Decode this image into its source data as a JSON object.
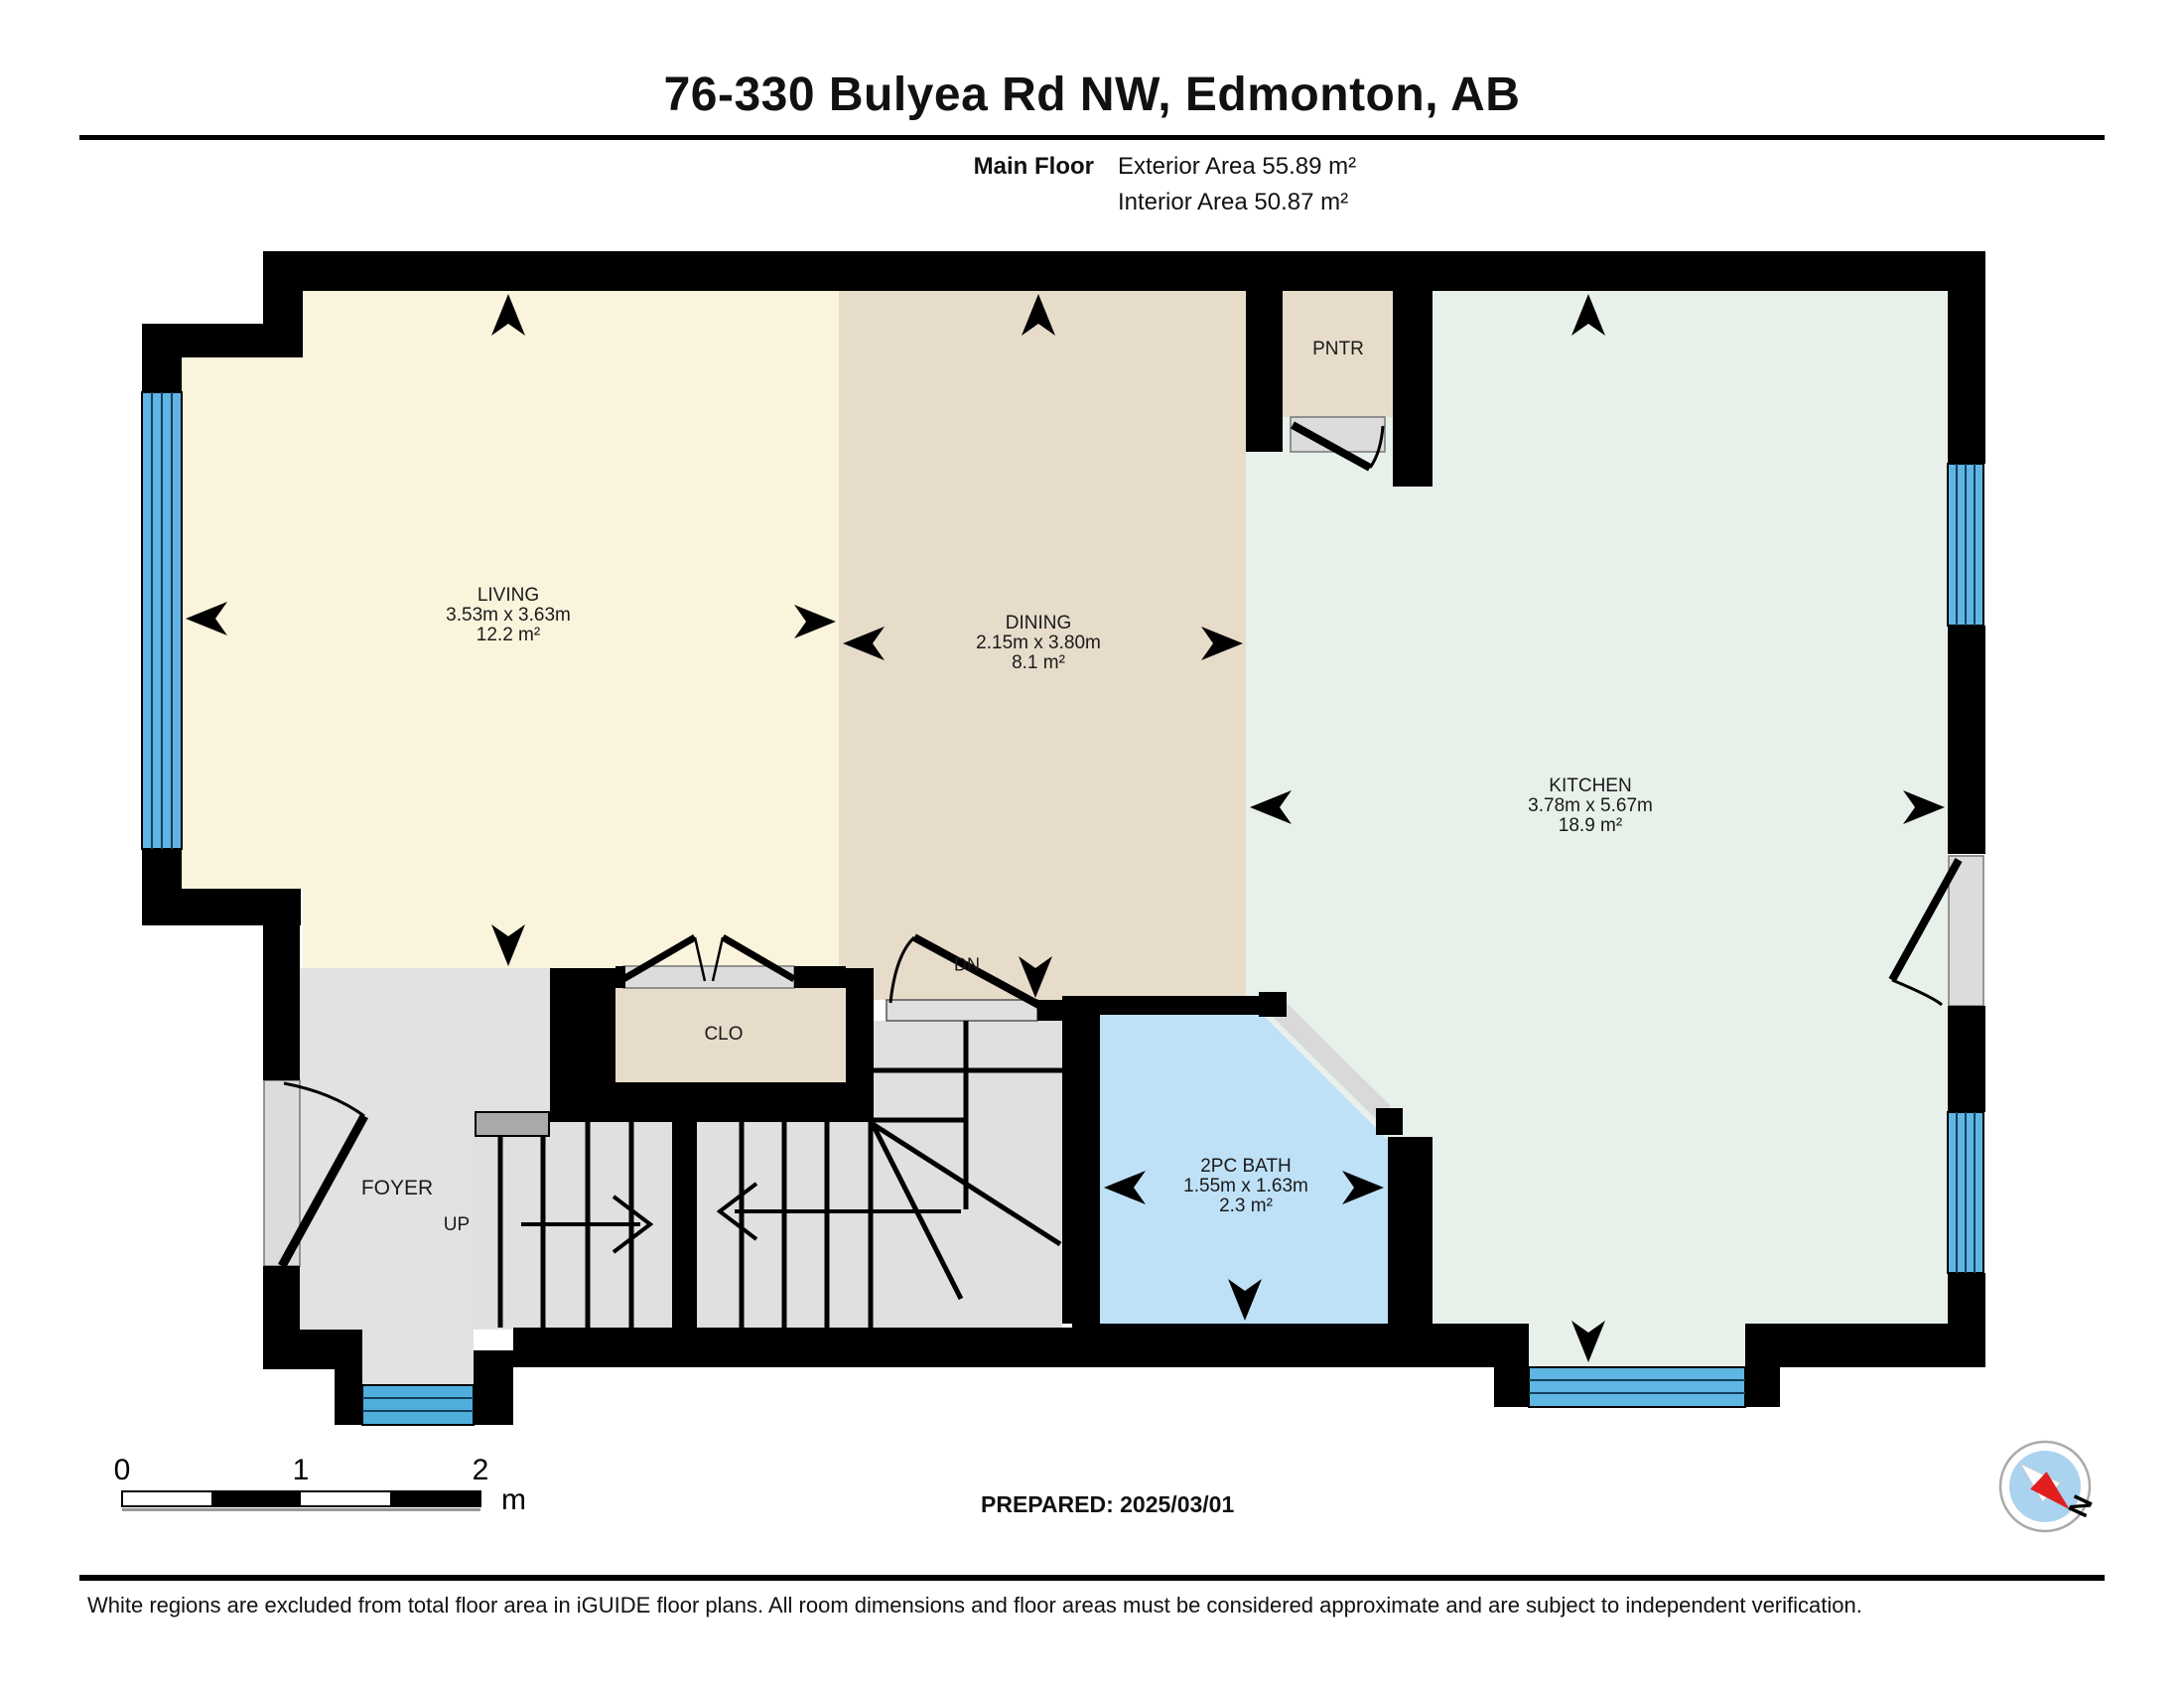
{
  "header": {
    "title": "76-330 Bulyea Rd NW, Edmonton, AB",
    "floor_label": "Main Floor",
    "exterior_area": "Exterior Area 55.89 m²",
    "interior_area": "Interior Area 50.87 m²"
  },
  "rooms": {
    "living": {
      "name": "LIVING",
      "dimensions": "3.53m x 3.63m",
      "area": "12.2 m²"
    },
    "dining": {
      "name": "DINING",
      "dimensions": "2.15m x 3.80m",
      "area": "8.1 m²"
    },
    "kitchen": {
      "name": "KITCHEN",
      "dimensions": "3.78m x 5.67m",
      "area": "18.9 m²"
    },
    "bath": {
      "name": "2PC BATH",
      "dimensions": "1.55m x 1.63m",
      "area": "2.3 m²"
    },
    "pantry": {
      "name": "PNTR"
    },
    "closet": {
      "name": "CLO"
    },
    "foyer": {
      "name": "FOYER"
    },
    "stairs_up": {
      "name": "UP"
    },
    "stairs_down": {
      "name": "DN"
    }
  },
  "scale_bar": {
    "tick_0": "0",
    "tick_1": "1",
    "tick_2": "2",
    "unit": "m"
  },
  "compass": {
    "label": "N"
  },
  "footer": {
    "prepared": "PREPARED: 2025/03/01",
    "disclaimer": "White regions are excluded from total floor area in iGUIDE floor plans. All room dimensions and floor areas must be considered approximate and are subject to independent verification."
  },
  "colors": {
    "wall": "#000000",
    "living": "#FBF4DD",
    "dining": "#E7DCCA",
    "kitchen": "#E7F1EA",
    "bath": "#BFE1F7",
    "floor_gray": "#E2E2E2",
    "window_blue": "#5FB5E3",
    "front_door_blue": "#4FAEDC",
    "door_jamb_gray": "#DCDCDC",
    "handrail_gray": "#A9A9A9"
  }
}
